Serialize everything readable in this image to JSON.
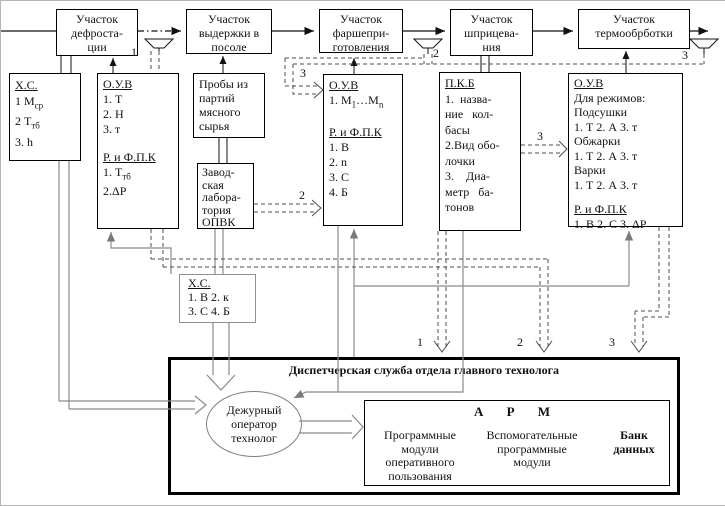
{
  "top_row": {
    "boxes": [
      {
        "label": "Участок\nдефроста-\nции"
      },
      {
        "label": "Участок\nвыдержки в\nпосоле"
      },
      {
        "label": "Участок\nфаршепри-\nготовления"
      },
      {
        "label": "Участок\nшприцева-\nния"
      },
      {
        "label": "Участок\nтермообрботки"
      }
    ]
  },
  "funnel_labels": [
    "1",
    "2",
    "3"
  ],
  "boxes": {
    "xc1": {
      "title": "Х.С.",
      "items": [
        {
          "t": "1  М",
          "sub": "ср"
        },
        {
          "t": "2  Т",
          "sub": "тб"
        },
        {
          "t": "3. h",
          "sub": ""
        }
      ]
    },
    "ouv1": {
      "title": "О.У.В",
      "items": [
        "1. Т",
        "2. Н",
        "3. т"
      ],
      "title2": "Р. и Ф.П.К",
      "items2": [
        {
          "t": "1. Т",
          "sub": "тб"
        },
        {
          "t": "2.ΔР",
          "sub": ""
        }
      ]
    },
    "proby": {
      "label": "Пробы из\nпартий\nмясного\nсырья"
    },
    "zavod": {
      "label": "Завод-\nская\nлабора-\nтория\nОПВК"
    },
    "ouv2": {
      "title": "О.У.В",
      "item1": {
        "a": "1. М",
        "s1": "1",
        "b": "…М",
        "s2": "n"
      },
      "title2": "Р. и Ф.П.К",
      "items2": [
        "1. В",
        "2. n",
        "3. С",
        "4. Б"
      ]
    },
    "pkb": {
      "title": "П.К.Б",
      "body": "1.  назва-\nние   кол-\nбасы\n2.Вид обо-\nлочки\n3.    Диа-\nметр   ба-\nтонов"
    },
    "ouv3": {
      "title": "О.У.В",
      "body": "Для режимов:\nПодсушки\n1. Т 2. А 3. т\nОбжарки\n1. Т 2. А 3. т\nВарки\n1. Т 2. А 3. т",
      "title2": "Р. и Ф.П.К",
      "body2": "1. В 2. С 3. ΔР"
    },
    "xc2": {
      "title": "Х.С.",
      "body": "1. В 2. к\n3. С 4. Б"
    }
  },
  "route_labels": {
    "ouv2_in": "3",
    "zavod_out": "2",
    "pkb_out": "3",
    "drop1": "1",
    "drop2": "2",
    "drop3": "3"
  },
  "dispatcher": {
    "title": "Диспетчерская служба отдела главного технолога",
    "operator": "Дежурный\nоператор\nтехнолог",
    "arm": {
      "title": "А Р М",
      "modules": [
        {
          "label": "Программные\nмодули\nоперативного\nпользования"
        },
        {
          "label": "Вспомогательные\nпрограммные\nмодули"
        },
        {
          "label": "Банк\nданных"
        }
      ]
    }
  }
}
